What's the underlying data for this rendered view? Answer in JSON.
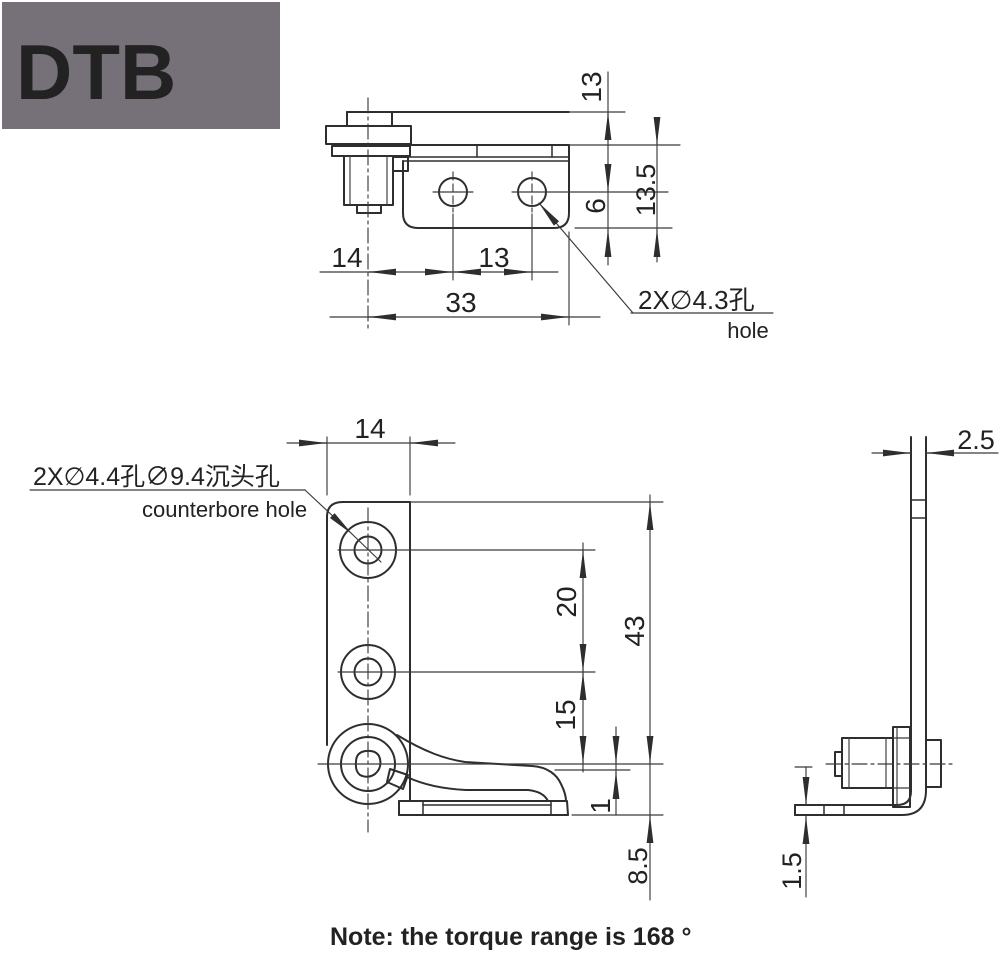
{
  "logo": {
    "text": "DTB"
  },
  "top_view": {
    "dim_13_top": "13",
    "dim_13_5": "13.5",
    "dim_6": "6",
    "dim_14": "14",
    "dim_13_holes": "13",
    "dim_33": "33",
    "hole_label_cn": "2X∅4.3孔",
    "hole_label_en": "hole"
  },
  "front_view": {
    "dim_14": "14",
    "dim_20": "20",
    "dim_43": "43",
    "dim_15": "15",
    "dim_1": "1",
    "dim_8_5": "8.5",
    "hole_label_cn": "2X∅4.4孔∅9.4沉头孔",
    "hole_label_en": "counterbore hole"
  },
  "side_view": {
    "dim_2_5": "2.5",
    "dim_1_5": "1.5"
  },
  "note": "Note:  the torque range is 168 °",
  "colors": {
    "line": "#2e2e2e",
    "logo_bg": "#767179",
    "logo_text": "#ffffff",
    "background": "#ffffff"
  }
}
